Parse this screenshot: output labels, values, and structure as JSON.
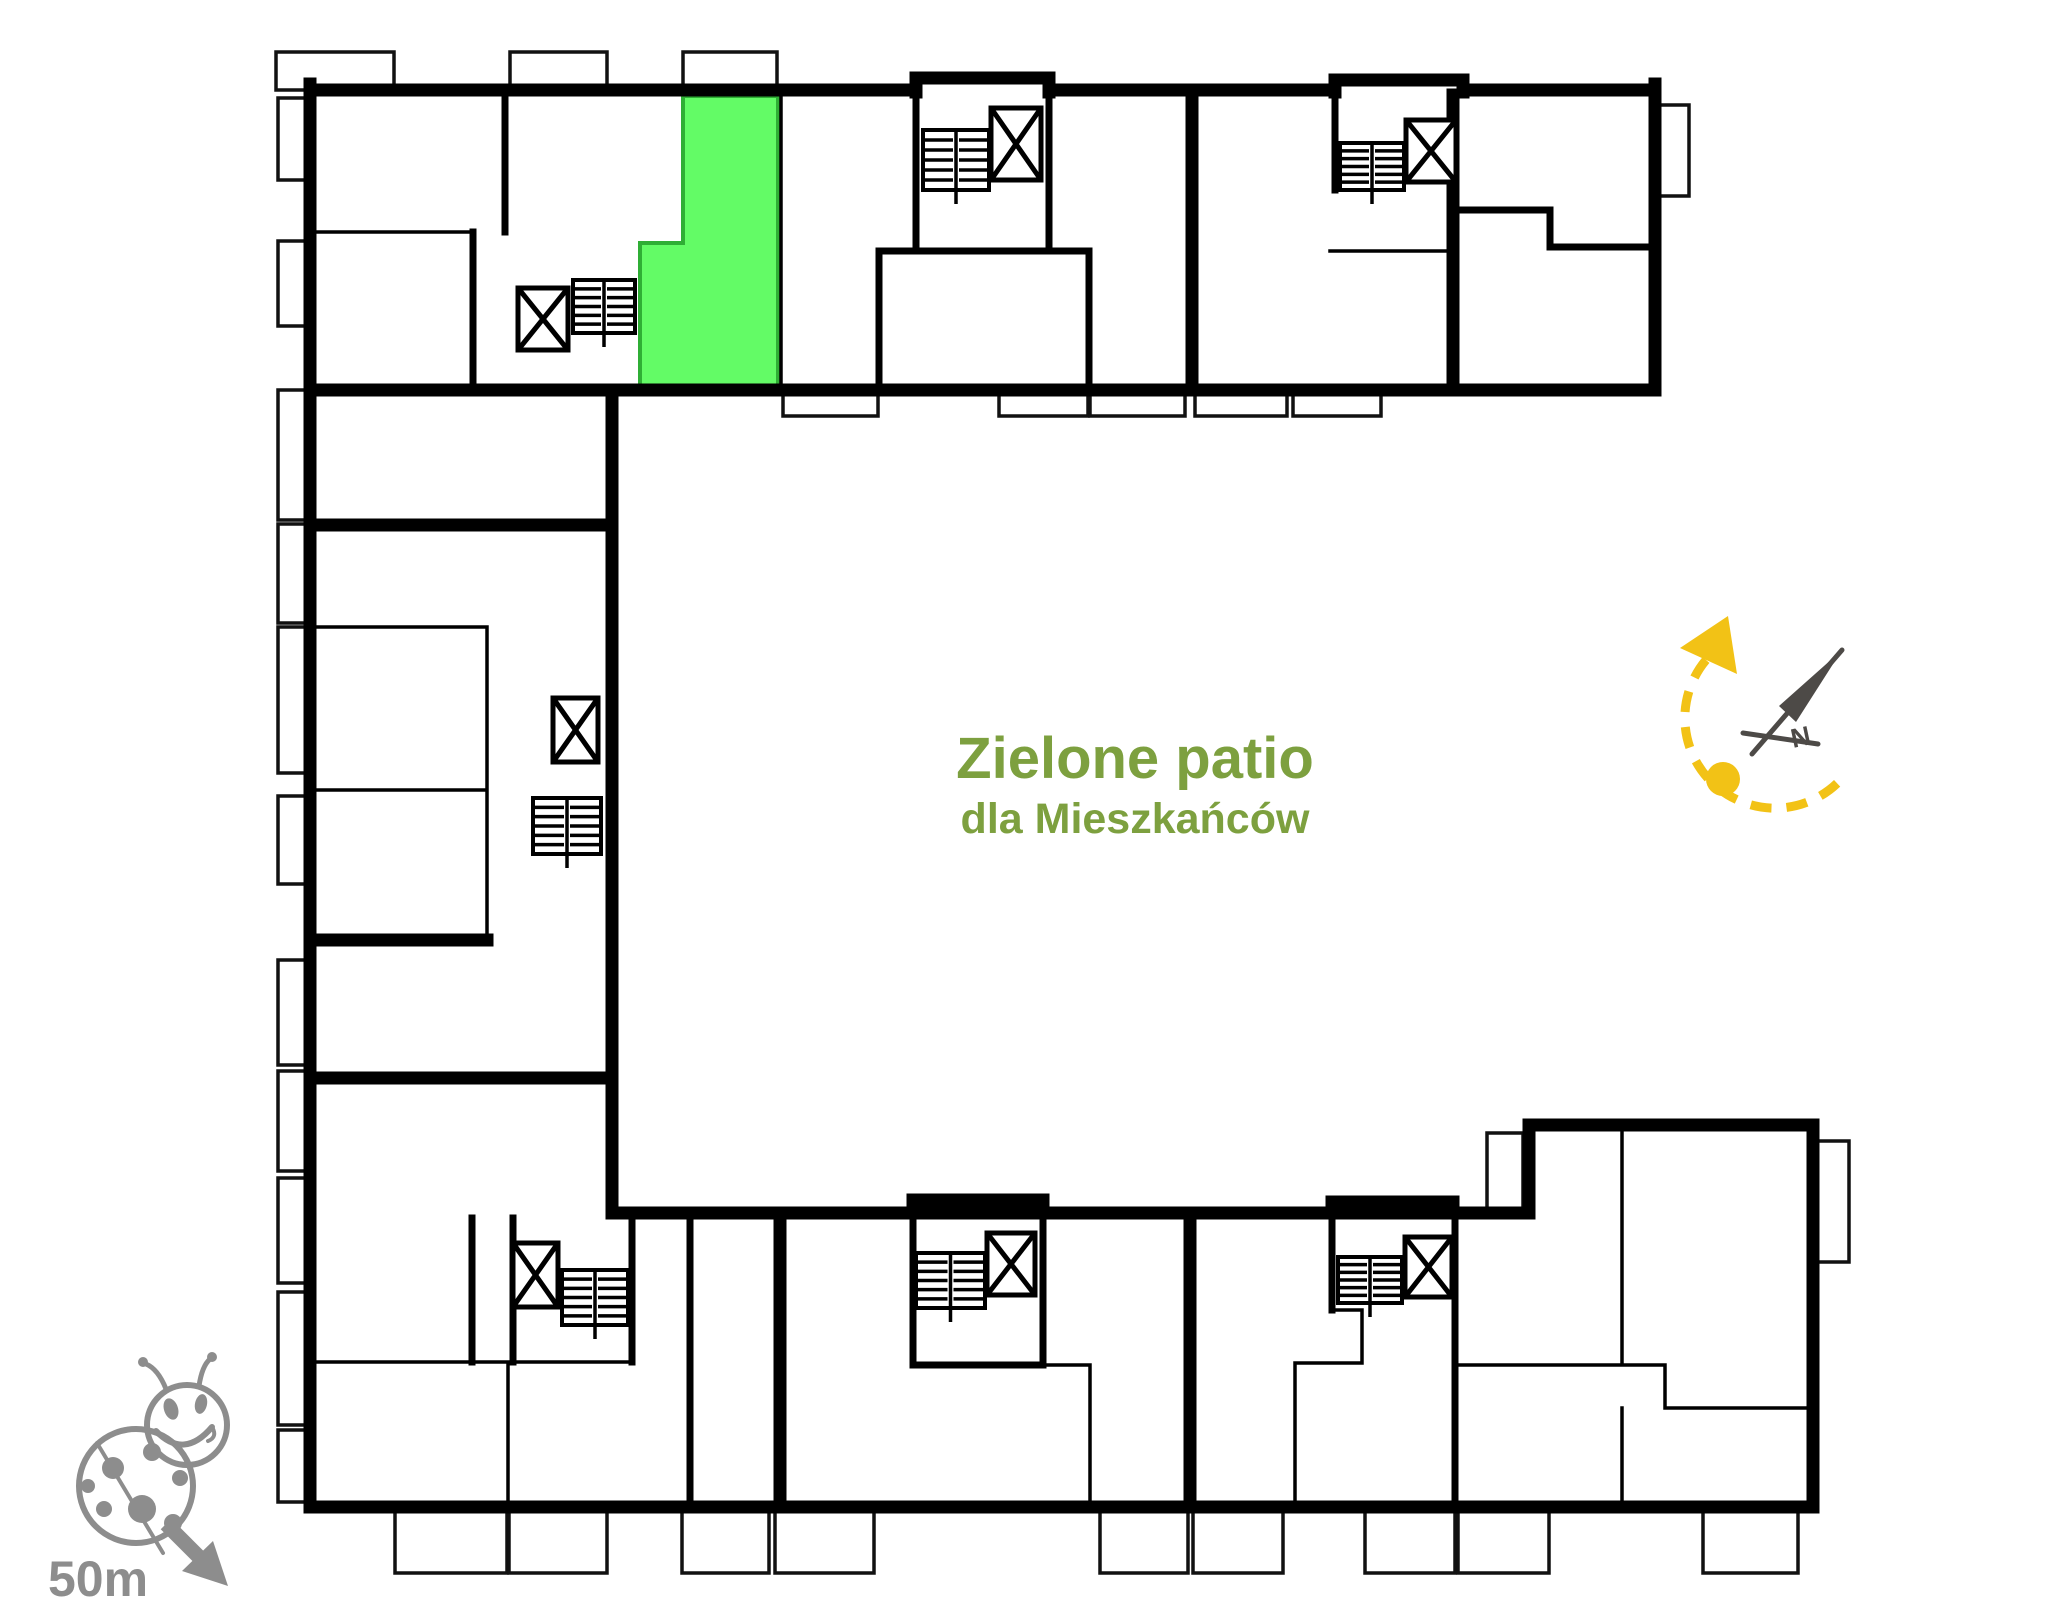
{
  "courtyard": {
    "title": "Zielone patio",
    "subtitle": "dla Mieszkańców"
  },
  "compass": {
    "north_label": "N"
  },
  "scale_indicator": {
    "label": "50m"
  },
  "colors": {
    "highlight_green": "#63fb66",
    "highlight_border": "#2fae35",
    "patio_text": "#7da03f",
    "sun_yellow": "#f2c216",
    "needle_gray": "#4d4a47",
    "ladybug_gray": "#8d8d8d",
    "wall_color": "#000000"
  }
}
